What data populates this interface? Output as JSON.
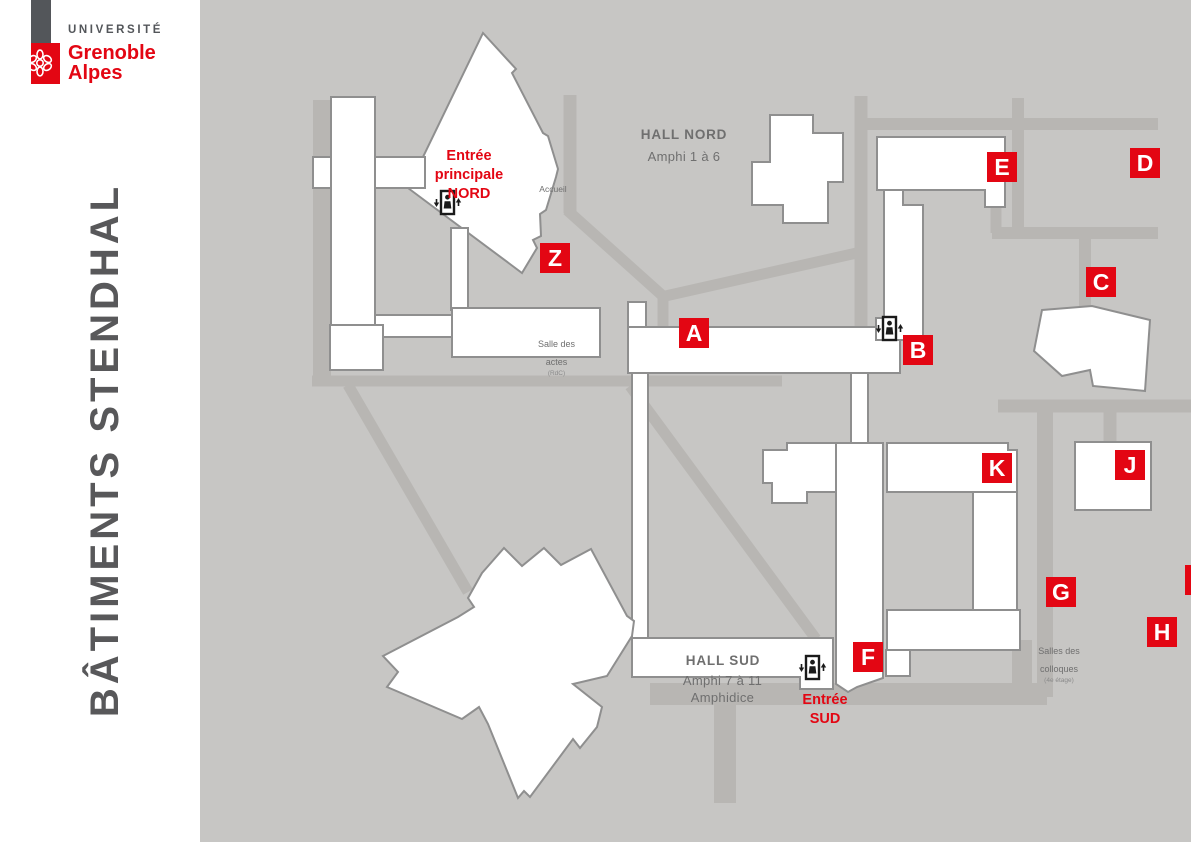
{
  "brand": {
    "line1": "UNIVERSITÉ",
    "line2": "Grenoble",
    "line3": "Alpes"
  },
  "sidebar_title": "BÂTIMENTS STENDHAL",
  "entrances": {
    "nord": "Entrée\nprincipale\nNORD",
    "sud": "Entrée\nSUD",
    "est": "Entrée\nEST"
  },
  "halls": {
    "nord_title": "HALL NORD",
    "nord_subtitle": "Amphi 1 à 6",
    "sud_title": "HALL SUD",
    "sud_subtitle": "Amphi 7 à 11\nAmphidice"
  },
  "rooms": {
    "accueil": "Accueil",
    "salle_actes": "Salle des\nactes",
    "salle_actes_floor": "(RdC)",
    "salles_colloques": "Salles des\ncolloques",
    "salles_colloques_floor": "(4e étage)"
  },
  "buildings": [
    {
      "letter": "A"
    },
    {
      "letter": "B"
    },
    {
      "letter": "C"
    },
    {
      "letter": "D"
    },
    {
      "letter": "E"
    },
    {
      "letter": "F"
    },
    {
      "letter": "G"
    },
    {
      "letter": "H"
    },
    {
      "letter": "I"
    },
    {
      "letter": "J"
    },
    {
      "letter": "K"
    },
    {
      "letter": "L"
    },
    {
      "letter": "P"
    },
    {
      "letter": "Z"
    }
  ],
  "icons": {
    "elevator": "elevator-icon",
    "logo_flower": "uga-flower-icon"
  },
  "colors": {
    "brand_red": "#e30613",
    "map_background": "#c7c6c4",
    "path_gray": "#b8b6b3",
    "building_fill": "#ffffff",
    "building_stroke": "#8f8f8f",
    "logo_gray": "#53565a",
    "label_gray": "#6f6f6f"
  }
}
